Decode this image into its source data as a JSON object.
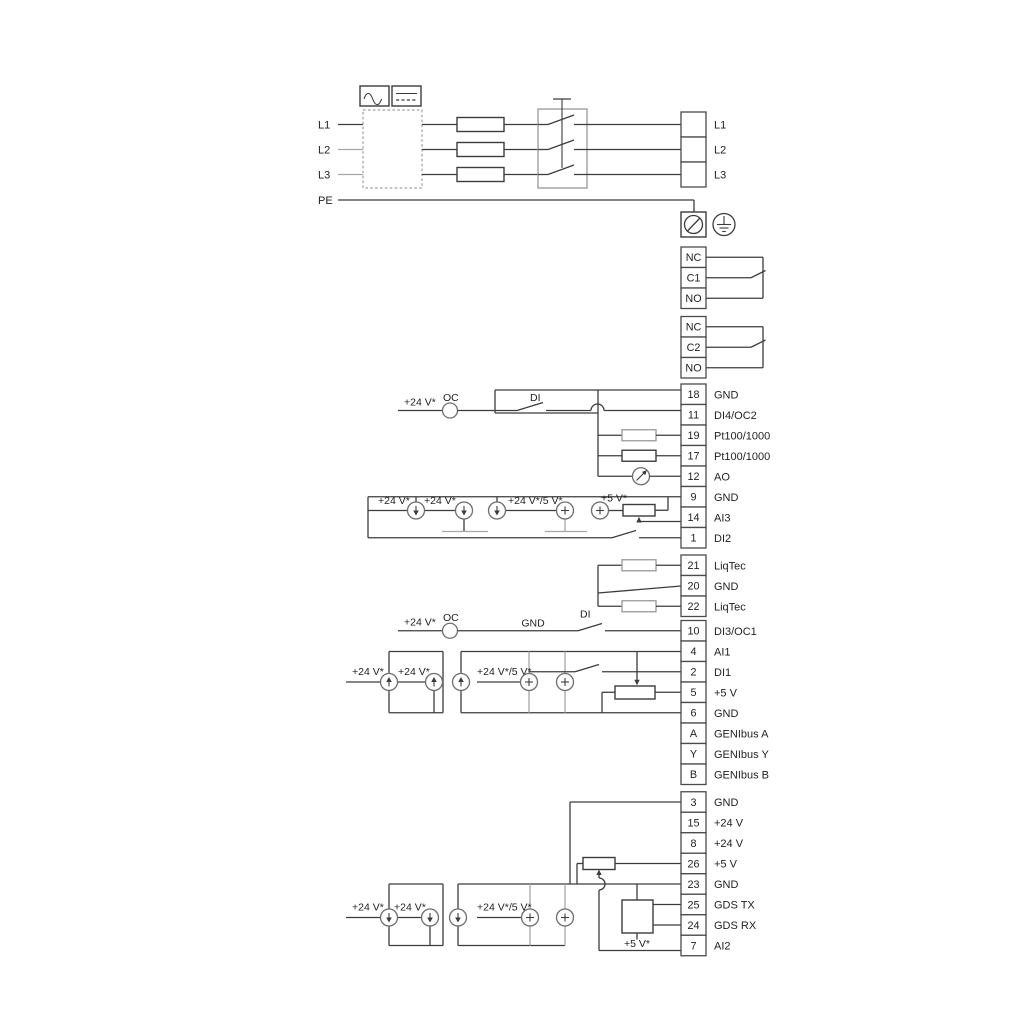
{
  "diagram": {
    "colors": {
      "line": "#3c3c3c",
      "muted": "#a6a6a6"
    },
    "mains": {
      "left_labels": [
        "L1",
        "L2",
        "L3",
        "PE"
      ]
    },
    "annotations": {
      "supply24": "+24 V*",
      "supply24or5": "+24 V*/5 V*",
      "supply5": "+5 V*",
      "oc": "OC",
      "di": "DI",
      "gnd": "GND"
    },
    "terminal_strips": [
      {
        "id": "power",
        "cells": [
          {
            "in": "",
            "out": "L1"
          },
          {
            "in": "",
            "out": "L2"
          },
          {
            "in": "",
            "out": "L3"
          }
        ]
      },
      {
        "id": "relay1",
        "cells": [
          {
            "in": "NC",
            "out": ""
          },
          {
            "in": "C1",
            "out": ""
          },
          {
            "in": "NO",
            "out": ""
          }
        ]
      },
      {
        "id": "relay2",
        "cells": [
          {
            "in": "NC",
            "out": ""
          },
          {
            "in": "C2",
            "out": ""
          },
          {
            "in": "NO",
            "out": ""
          }
        ]
      },
      {
        "id": "io1",
        "cells": [
          {
            "in": "18",
            "out": "GND"
          },
          {
            "in": "11",
            "out": "DI4/OC2"
          },
          {
            "in": "19",
            "out": "Pt100/1000"
          },
          {
            "in": "17",
            "out": "Pt100/1000"
          },
          {
            "in": "12",
            "out": "AO"
          },
          {
            "in": "9",
            "out": "GND"
          },
          {
            "in": "14",
            "out": "AI3"
          },
          {
            "in": "1",
            "out": "DI2"
          }
        ]
      },
      {
        "id": "liqtec",
        "cells": [
          {
            "in": "21",
            "out": "LiqTec"
          },
          {
            "in": "20",
            "out": "GND"
          },
          {
            "in": "22",
            "out": "LiqTec"
          }
        ]
      },
      {
        "id": "io2",
        "cells": [
          {
            "in": "10",
            "out": "DI3/OC1"
          },
          {
            "in": "4",
            "out": "AI1"
          },
          {
            "in": "2",
            "out": "DI1"
          },
          {
            "in": "5",
            "out": "+5 V"
          },
          {
            "in": "6",
            "out": "GND"
          },
          {
            "in": "A",
            "out": "GENIbus A"
          },
          {
            "in": "Y",
            "out": "GENIbus Y"
          },
          {
            "in": "B",
            "out": "GENIbus B"
          }
        ]
      },
      {
        "id": "io3",
        "cells": [
          {
            "in": "3",
            "out": "GND"
          },
          {
            "in": "15",
            "out": "+24 V"
          },
          {
            "in": "8",
            "out": "+24 V"
          },
          {
            "in": "26",
            "out": "+5 V"
          },
          {
            "in": "23",
            "out": "GND"
          },
          {
            "in": "25",
            "out": "GDS TX"
          },
          {
            "in": "24",
            "out": "GDS RX"
          },
          {
            "in": "7",
            "out": "AI2"
          }
        ]
      }
    ]
  }
}
